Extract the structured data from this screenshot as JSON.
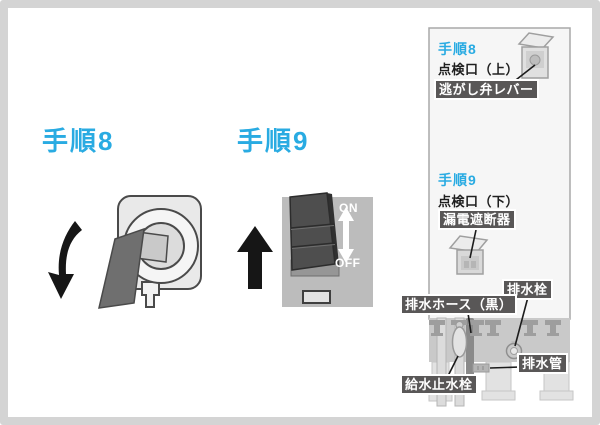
{
  "colors": {
    "accent": "#29abe2",
    "label_bg": "#595757",
    "panel_gray": "#bcbcbc",
    "unit_body": "#f6f6f6"
  },
  "step8": {
    "title": "手順8"
  },
  "step9": {
    "title": "手順9"
  },
  "breaker_switch": {
    "on": "ON",
    "off": "OFF"
  },
  "unit_diagram": {
    "step8_ref": "手順8",
    "inspection_port_upper": "点検口（上）",
    "relief_valve_lever": "逃がし弁レバー",
    "step9_ref": "手順9",
    "inspection_port_lower": "点検口（下）",
    "leakage_breaker": "漏電遮断器",
    "drain_plug": "排水栓",
    "drain_hose_black": "排水ホース（黒）",
    "drain_pipe": "排水管",
    "water_supply_stop_valve": "給水止水栓"
  }
}
